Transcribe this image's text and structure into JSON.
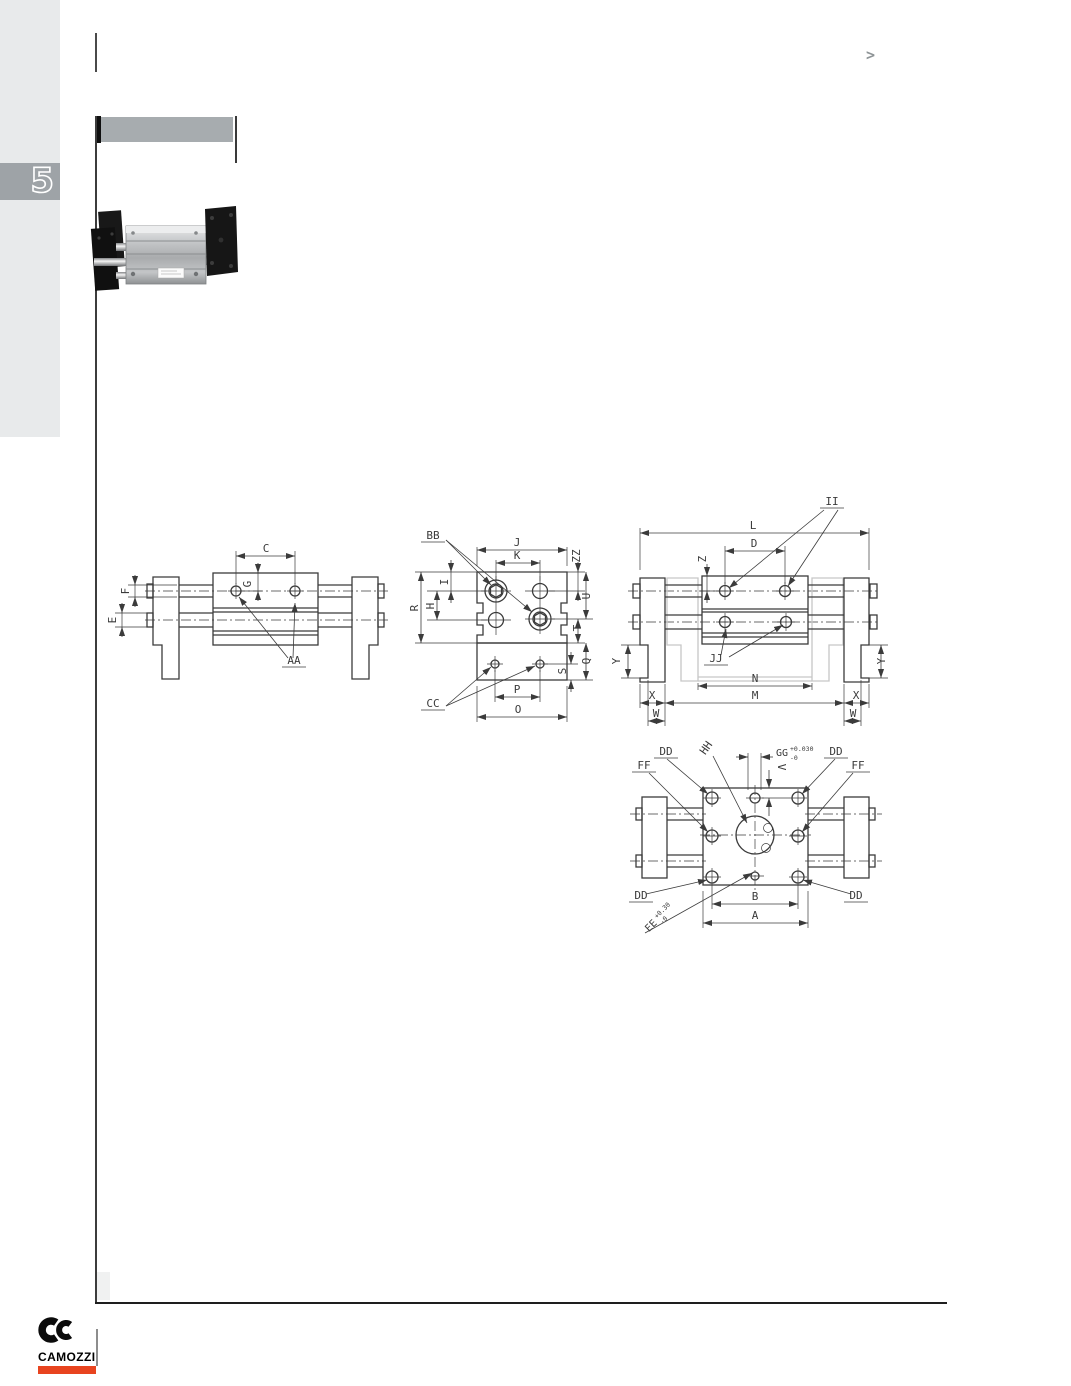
{
  "page": {
    "section_tab": "5",
    "nav_marker": ">"
  },
  "brand": {
    "name": "CAMOZZI"
  },
  "colors": {
    "accent_red": "#e8441f",
    "sidebar_gray": "#e8eaeb",
    "tab_gray": "#9ea3a7",
    "header_gray": "#a7acaf",
    "drawing_line": "#3b3b3b",
    "ghost_gray": "#c7c7c7"
  },
  "drawings": {
    "side_view": {
      "labels": {
        "c": "C",
        "g": "G",
        "f": "F",
        "e": "E",
        "aa": "AA"
      }
    },
    "end_view": {
      "labels": {
        "bb": "BB",
        "j": "J",
        "k": "K",
        "zz": "ZZ",
        "u": "U",
        "t": "T",
        "s": "S",
        "q": "Q",
        "r": "R",
        "h": "H",
        "i": "I",
        "p": "P",
        "o": "O",
        "cc": "CC"
      }
    },
    "open_view": {
      "labels": {
        "ii": "II",
        "l": "L",
        "d": "D",
        "z": "Z",
        "y": "Y",
        "jj": "JJ",
        "n": "N",
        "m": "M",
        "x": "X",
        "w": "W"
      }
    },
    "face_view": {
      "labels": {
        "dd": "DD",
        "ff": "FF",
        "hh": "HH",
        "gg": "GG",
        "gg_tol_upper": "+0.030",
        "gg_tol_lower": "-0",
        "v": "V",
        "b": "B",
        "a": "A",
        "ee": "EE",
        "ee_tol_upper": "+0.30",
        "ee_tol_lower": "-0"
      }
    }
  }
}
